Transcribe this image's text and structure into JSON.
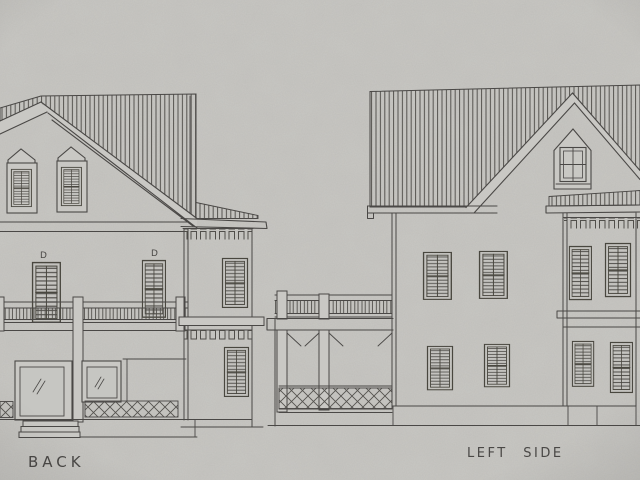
{
  "drawing": {
    "type": "architectural elevation sketch",
    "elevations": [
      {
        "id": "back",
        "label": "BACK"
      },
      {
        "id": "left-side",
        "label": "LEFT SIDE"
      }
    ],
    "door_marks": {
      "d1": "D",
      "d2": "D"
    }
  },
  "colors": {
    "paper": "#c9c8c4",
    "ink": "#4a4846"
  }
}
